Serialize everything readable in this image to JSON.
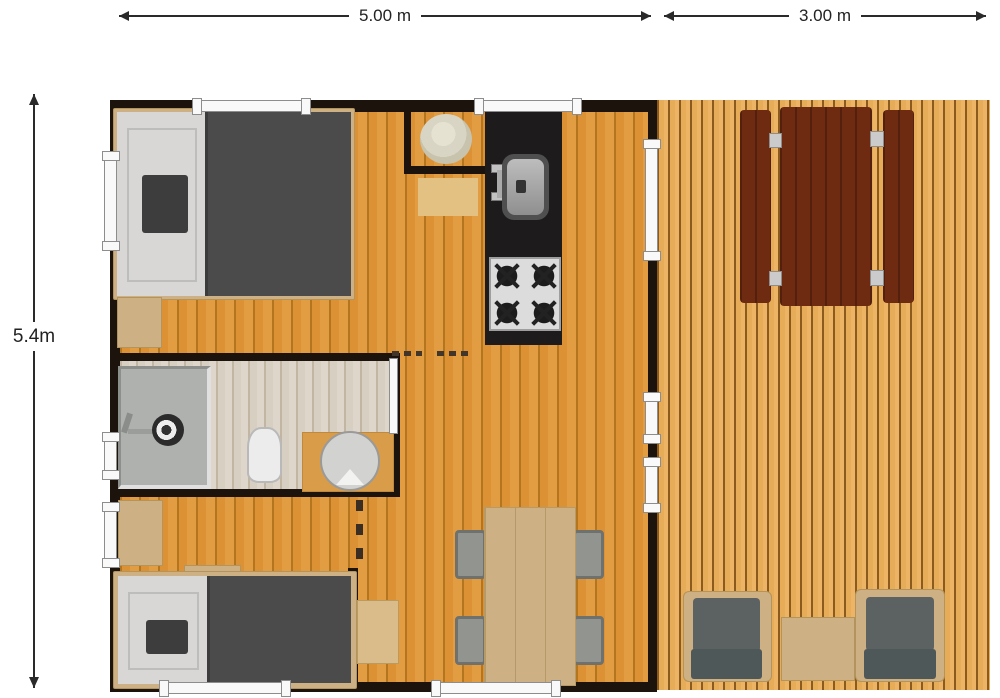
{
  "dimensions": {
    "main_width": "5.00 m",
    "deck_width": "3.00 m",
    "depth": "5.4m"
  },
  "colors": {
    "wall": "#1c130c",
    "floor": "#dc9134",
    "floor_line": "#b4751f",
    "deck_floor": "#e7ac57",
    "deck_line": "#8a5a1e",
    "bath_floor": "#d7cfc2",
    "bath_line": "#c2b5a1",
    "counter": "#1d1b1b",
    "wood": "#cdb083",
    "duvet": "#4b4b4b",
    "sheet": "#d8d7d5",
    "pillow": "#3d3d3d",
    "picnic_wood": "#6f2b12",
    "cushion": "#5c6162",
    "chair_gray": "#92958f",
    "chair_edge": "#6e716d",
    "window_face": "#f9f9f9",
    "window_edge": "#8d8d8d",
    "dim": "#2a2a2a",
    "shower_pan": "#aeb1ae",
    "basin": "#d2d2d0",
    "boiler": "#d9d5c4",
    "sink_outer": "#4f4f4f",
    "stove_face": "#dcdcdc",
    "mat": "#e2c183",
    "desk": "#d9bc8a"
  }
}
